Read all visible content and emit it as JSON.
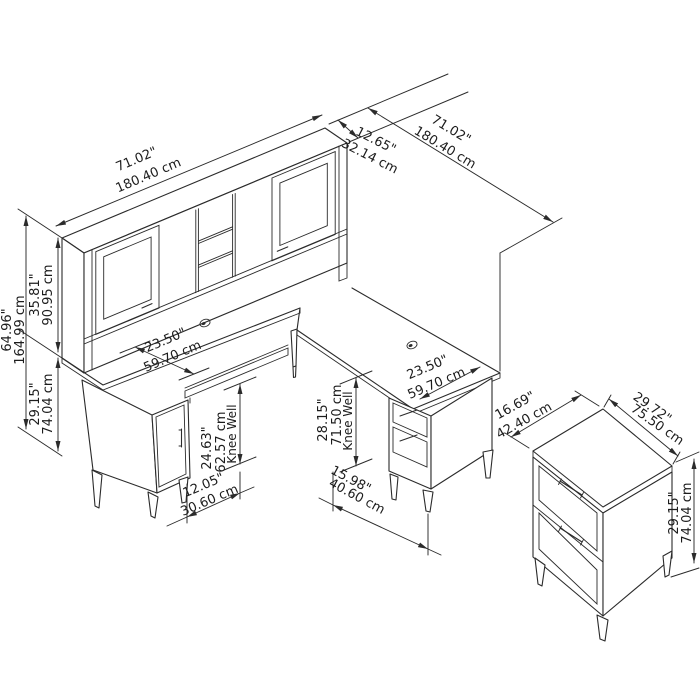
{
  "diagram": {
    "type": "furniture-dimension-drawing",
    "background": "#ffffff",
    "line_color": "#2b2b2b",
    "objects": [
      "l-shaped-desk-with-hutch",
      "lateral-file-cabinet"
    ],
    "dims": {
      "hutch_width": {
        "in": "71.02\"",
        "cm": "180.40 cm"
      },
      "hutch_depth": {
        "in": "12.65\"",
        "cm": "32.14 cm"
      },
      "overall_depth": {
        "in": "71.02\"",
        "cm": "180.40 cm"
      },
      "overall_height": {
        "in": "64.96\"",
        "cm": "164.99 cm"
      },
      "hutch_height": {
        "in": "35.81\"",
        "cm": "90.95 cm"
      },
      "desk_height": {
        "in": "29.15\"",
        "cm": "74.04 cm"
      },
      "desk_depth": {
        "in": "23.50\"",
        "cm": "59.70 cm"
      },
      "return_depth": {
        "in": "23.50\"",
        "cm": "59.70 cm"
      },
      "left_knee_well": {
        "in": "24.63\"",
        "cm": "62.57 cm",
        "label": "Knee Well"
      },
      "right_knee_well": {
        "in": "28.15\"",
        "cm": "71.50 cm",
        "label": "Knee Well"
      },
      "left_knee_well_width": {
        "in": "12.05\"",
        "cm": "30.60 cm"
      },
      "right_knee_well_width": {
        "in": "15.98\"",
        "cm": "40.60 cm"
      },
      "file_cabinet_depth": {
        "in": "16.69\"",
        "cm": "42.40 cm"
      },
      "file_cabinet_width": {
        "in": "29.72\"",
        "cm": "75.50 cm"
      },
      "file_cabinet_height": {
        "in": "29.15\"",
        "cm": "74.04 cm"
      }
    }
  }
}
